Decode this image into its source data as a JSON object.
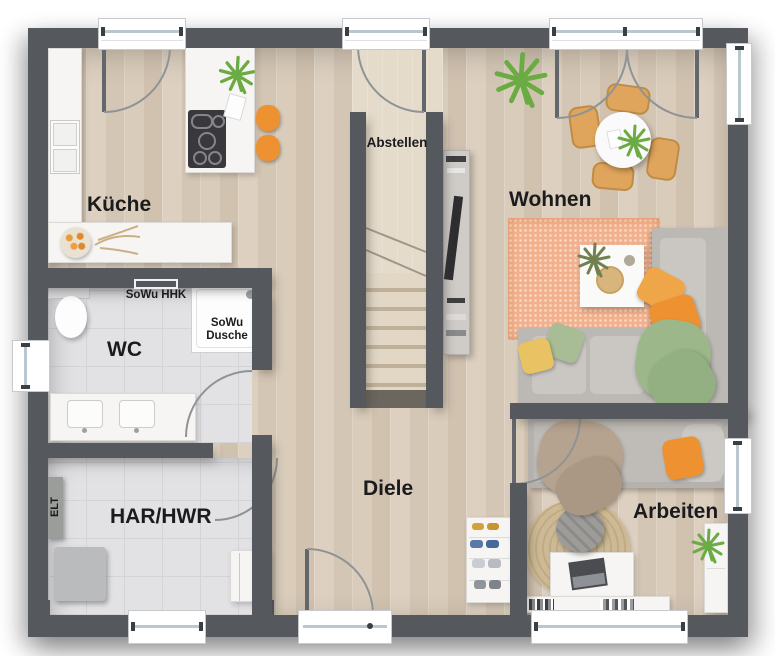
{
  "plan": {
    "rooms": {
      "kueche": {
        "label": "Küche"
      },
      "wc": {
        "label": "WC"
      },
      "har_hwr": {
        "label": "HAR/HWR"
      },
      "diele": {
        "label": "Diele"
      },
      "wohnen": {
        "label": "Wohnen"
      },
      "arbeiten": {
        "label": "Arbeiten"
      },
      "abstellen": {
        "label": "Abstellen"
      }
    },
    "annotations": {
      "sowu_hhk": {
        "label": "SoWu HHK"
      },
      "sowu_dusche": {
        "label": "SoWu\nDusche"
      },
      "elt": {
        "label": "ELT"
      }
    }
  },
  "colors": {
    "wall": "#55595e",
    "floor_wood": "#d7c9b8",
    "floor_wood_light": "#e4dbca",
    "tile": "#e2e2e5",
    "tile_line": "#d4d4d8",
    "counter_white": "#f6f5f3",
    "accent_orange": "#ee9231",
    "chair_tan": "#dfa55c",
    "rug_salmon": "#f2b18c",
    "sofa_gray": "#bcb9b5",
    "cushion_gray": "#cac7c3",
    "pillow_yellow": "#e8c263",
    "pillow_sage": "#a8bc95",
    "blanket_green": "#9cb88b",
    "blanket_tan": "#b6a38f",
    "jute": "#cab795",
    "plant_green": "#6aab43",
    "plant_olive": "#71804f",
    "stair_wood": "#ddd2bf",
    "door_arc": "#8f9396",
    "window_glass": "#b9c7ce",
    "label_text": "#1b1b1d"
  }
}
